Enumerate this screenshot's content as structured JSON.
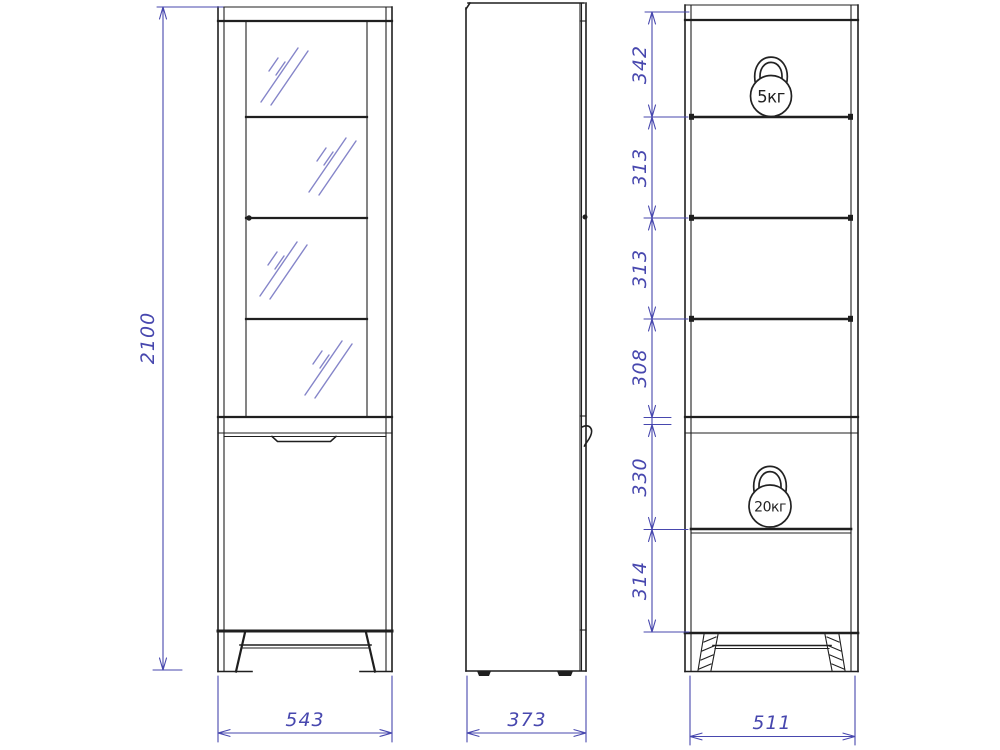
{
  "drawing": {
    "overall_height": "2100",
    "front_width": "543",
    "side_depth": "373",
    "interior_width": "511",
    "spacings": [
      "342",
      "313",
      "313",
      "308",
      "330",
      "314"
    ],
    "weight_upper": "5кг",
    "weight_lower": "20кг",
    "colors": {
      "ink": "#1f1f1f",
      "dimension": "#4747ae",
      "glass_hatch": "#8585c9"
    }
  }
}
